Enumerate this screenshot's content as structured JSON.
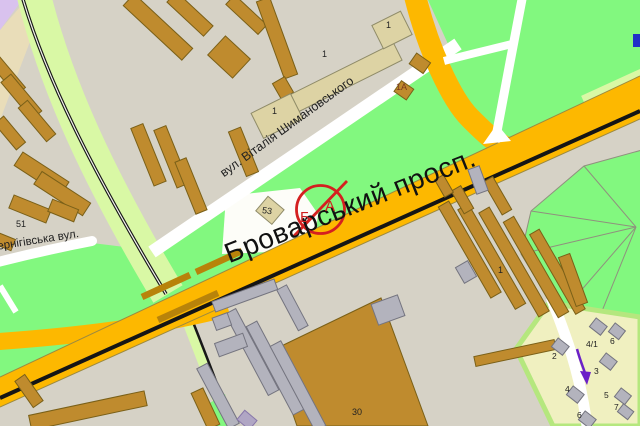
{
  "map": {
    "streets": {
      "prospekt": "Броварський просп.",
      "shymanovskoho": "вул. Віталія Шимановського",
      "chernihivska": "Чернігівська вул."
    },
    "marker": {
      "letter_left": "Б",
      "letter_right": "А"
    },
    "building_numbers": {
      "n51": "51",
      "n53": "53",
      "n1a": "1А",
      "n1_complex_low": "1",
      "n1_complex_mid": "1",
      "n1_complex_top": "1",
      "n1_industrial": "1",
      "n30": "30",
      "n2": "2",
      "n3": "3",
      "n4": "4",
      "n4_1": "4/1",
      "n5": "5",
      "n6_top": "6",
      "n6_bottom": "6",
      "n7": "7"
    },
    "colors": {
      "background_gray": "#d6d2c6",
      "park_green": "#82f87f",
      "strip_green": "#d9f8a5",
      "road_orange": "#fdb800",
      "overpass_orange": "#b8830a",
      "building_brown": "#bf8b2e",
      "building_beige": "#ddd3a4",
      "building_gray": "#b3b3bd",
      "residential_yellow": "#f0f0c0",
      "marker_red": "#d42020",
      "oneway_purple": "#6b21c8"
    }
  }
}
